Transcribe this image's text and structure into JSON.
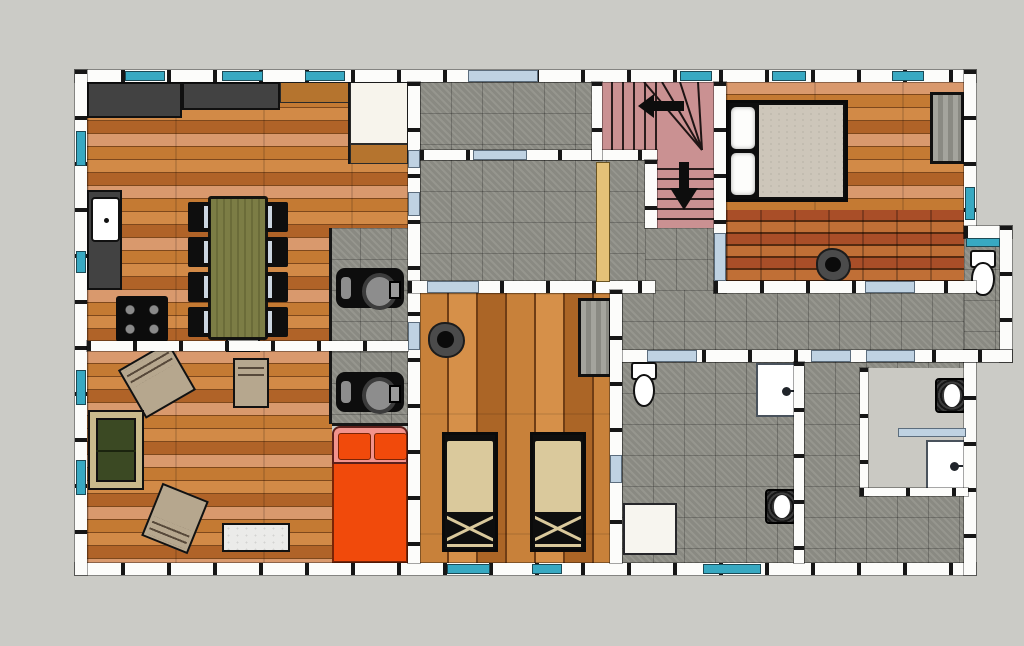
{
  "canvas": {
    "width": 1024,
    "height": 646
  },
  "colors": {
    "bg": "#cbcbc6",
    "wall": "#fcfcfa",
    "post": "#161616",
    "win": "#38a9c2",
    "door": "#bfd2e2",
    "tile": "#8f8f87",
    "bare": "#cac9c3",
    "salmon": "#d9996d",
    "wooda": "#b06328",
    "woodb": "#c47a33",
    "woodc": "#d28a47",
    "woodseam": "#7e481c",
    "plank1": "#c8813a",
    "plank2": "#d69049",
    "plank3": "#ab6526",
    "plankseam": "#6f3d15",
    "brick1": "#a94e28",
    "brick2": "#c06f36",
    "brickseam": "#552a10",
    "stair": "#ca9192",
    "stairline": "#2a1d1d",
    "tan": "#e4c178",
    "counter": "#424242",
    "woodcounter": "#b5742e",
    "table": "#7c7d45",
    "tstripe": "#6b6c39",
    "sofa": "#3b4923",
    "sofatrim": "#c9ba8c",
    "armchair": "#b6a78e",
    "mattress": "#dac99c",
    "mmattress": "#cdc6ba",
    "orange": "#f14a0b",
    "pink": "#f2938c",
    "rug": "#ebebe9",
    "dresser1": "#a4a49d",
    "dresser2": "#8a8a83",
    "pot": "#4b4b4b"
  },
  "plan": {
    "type": "residential-floor-plan-top-view",
    "style": "sketchup-color-render",
    "rooms": [
      {
        "name": "kitchen-dining",
        "floor": "hardwood-horizontal",
        "features": [
          "l-shaped-counter",
          "wood-counter",
          "pantry",
          "sink",
          "stove",
          "dining-table",
          "chairs-x9"
        ]
      },
      {
        "name": "living-room",
        "floor": "hardwood-horizontal",
        "features": [
          "sofa",
          "armchair-x3",
          "marble-rug"
        ]
      },
      {
        "name": "utility-strip",
        "floor": "stone-tile",
        "features": [
          "appliance-x2"
        ]
      },
      {
        "name": "bed-nook",
        "floor": "covered-by-bed",
        "features": [
          "orange-double-bed",
          "pink-headboard",
          "pillow-x2"
        ]
      },
      {
        "name": "entry-hall",
        "floor": "stone-tile",
        "features": []
      },
      {
        "name": "main-hall",
        "floor": "stone-tile",
        "features": [
          "wood-screen"
        ]
      },
      {
        "name": "staircase",
        "floor": "stairs-pink",
        "features": [
          "upper-run",
          "winder-treads",
          "lower-run",
          "direction-arrow-x2"
        ]
      },
      {
        "name": "master-bedroom",
        "floor": "hardwood-plus-brick",
        "features": [
          "double-bed",
          "pillow-x2",
          "dresser",
          "floor-basin"
        ]
      },
      {
        "name": "twin-bedroom",
        "floor": "hardwood-vertical",
        "features": [
          "single-bed-x2",
          "dresser",
          "floor-basin"
        ]
      },
      {
        "name": "corridor",
        "floor": "stone-tile",
        "features": []
      },
      {
        "name": "bathroom-middle",
        "floor": "stone-tile",
        "features": [
          "toilet",
          "washstand",
          "round-basin",
          "shower-tray"
        ]
      },
      {
        "name": "bathroom-right",
        "floor": "stone-tile-and-bare",
        "features": [
          "round-basin",
          "washstand",
          "glass-partition"
        ]
      },
      {
        "name": "toilet-niche",
        "floor": "stone-tile",
        "features": [
          "toilet",
          "window"
        ]
      }
    ],
    "openings": {
      "windows": 15,
      "doors": 12,
      "window_color_name": "cyan",
      "door_color_name": "pale-blue"
    }
  }
}
